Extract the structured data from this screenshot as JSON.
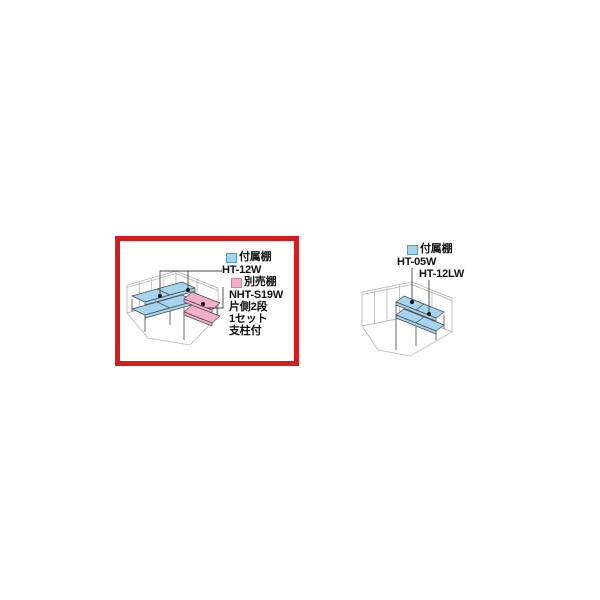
{
  "page": {
    "background": "#ffffff"
  },
  "colors": {
    "attached_shelf_blue": "#a5d5ee",
    "optional_shelf_pink": "#f3b0ca",
    "highlight_border_red": "#d41c1c",
    "wall_line_gray": "#b5b5b5",
    "drawing_line_dark": "#4a4a4a"
  },
  "left_panel": {
    "highlighted": true,
    "legend_attached": {
      "label": "付属棚",
      "model": "HT-12W"
    },
    "legend_optional": {
      "label": "別売棚",
      "model": "NHT-S19W",
      "spec_tiers": "片側2段",
      "spec_set": "1セット",
      "spec_posts": "支柱付"
    }
  },
  "right_panel": {
    "highlighted": false,
    "legend_attached": {
      "label": "付属棚",
      "model_a": "HT-05W",
      "model_b": "HT-12LW"
    }
  }
}
